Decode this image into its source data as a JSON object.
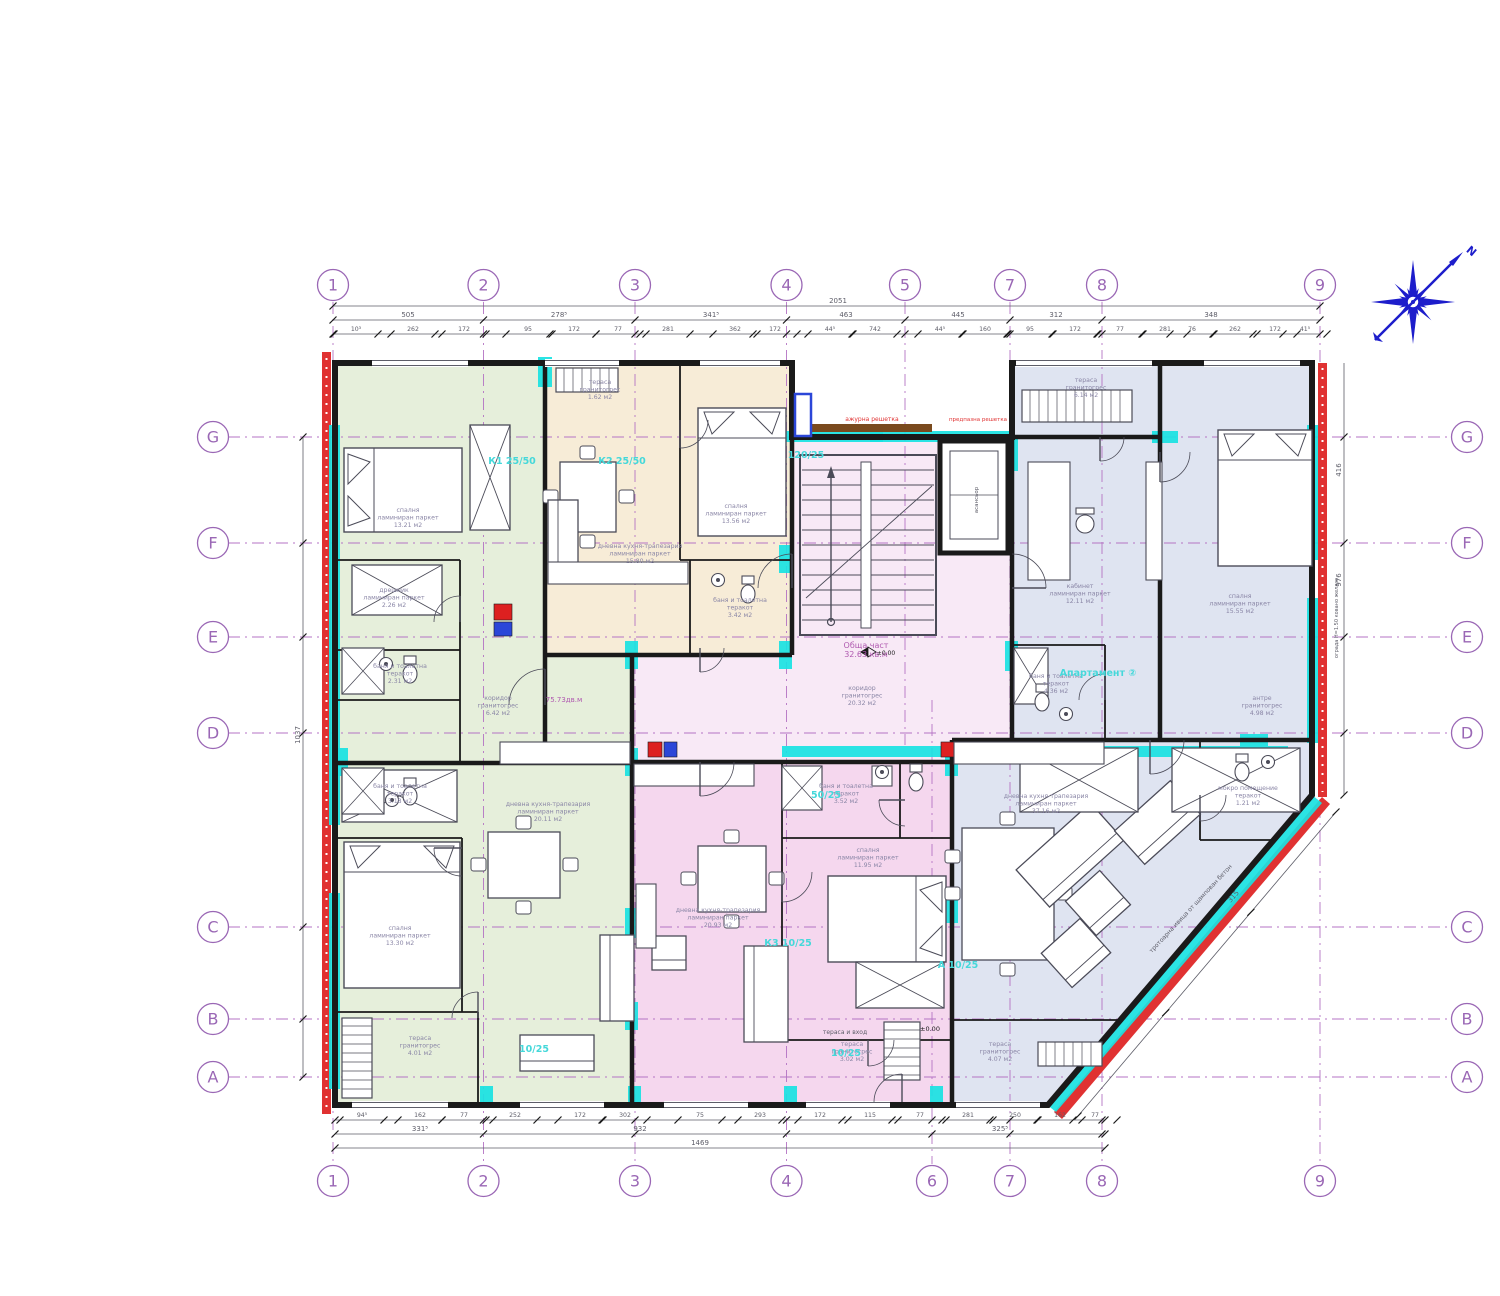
{
  "colors": {
    "green": "#e6efdb",
    "cream": "#f7ecd7",
    "core": "#f8e9f6",
    "pink": "#f5d7ee",
    "blue": "#dfe4f1",
    "cyan": "#19e2e2",
    "red": "#e03232",
    "wall": "#1a1a1a",
    "dim": "#5d5d68",
    "grid": "#b473c4",
    "bubble": "#9a67b5",
    "label": "#8a86a6",
    "code": "#45d8da",
    "purple": "#b05ab0",
    "compass": "#1d1dcb",
    "furn": "#4b4b58",
    "wood": "#7a4a1e",
    "stove": "#dd2020",
    "fridge": "#2b46d8",
    "white": "#ffffff"
  },
  "grid": {
    "top": [
      "1",
      "2",
      "3",
      "4",
      "5",
      "7",
      "8",
      "9"
    ],
    "bottom": [
      "1",
      "2",
      "3",
      "4",
      "6",
      "7",
      "8",
      "9"
    ],
    "left": [
      "G",
      "F",
      "E",
      "D",
      "C",
      "B",
      "A"
    ],
    "right": [
      "G",
      "F",
      "E",
      "D",
      "C",
      "B",
      "A"
    ]
  },
  "compass": {
    "north": "N"
  },
  "dims": {
    "top_total": "2051",
    "top_major": [
      "505",
      "278⁵",
      "341⁵",
      "463",
      "445",
      "312",
      "348"
    ],
    "top_minor": [
      "10³",
      "262",
      "172",
      "95",
      "172",
      "77",
      "281",
      "362",
      "172",
      "44⁵",
      "742",
      "44⁵",
      "160",
      "95",
      "172",
      "77",
      "281",
      "76",
      "262",
      "172",
      "41⁵"
    ],
    "bottom_minor": [
      "94⁵",
      "162",
      "77",
      "252",
      "172",
      "302",
      "75",
      "293",
      "172",
      "115",
      "77",
      "281",
      "250",
      "162",
      "77"
    ],
    "bottom_major": [
      "331⁵",
      "932",
      "325⁵"
    ],
    "bottom_total": "1469",
    "left": [
      "1037"
    ],
    "right": [
      "416",
      "976"
    ],
    "diag": [
      "315"
    ]
  },
  "rooms": [
    {
      "name": "спалня",
      "mat": "ламиниран паркет",
      "area": "13.21 м2"
    },
    {
      "name": "дрешник",
      "mat": "ламиниран паркет",
      "area": "2.26 м2"
    },
    {
      "name": "баня и тоалетна",
      "mat": "теракот",
      "area": "2.31 м2"
    },
    {
      "name": "баня и тоалетна",
      "mat": "теракот",
      "area": "3.18 м2"
    },
    {
      "name": "коридор",
      "mat": "гранитогрес",
      "area": "6.42 м2"
    },
    {
      "name": "дневна кухня-трапезария",
      "mat": "ламиниран паркет",
      "area": "20.11 м2"
    },
    {
      "name": "спалня",
      "mat": "ламиниран паркет",
      "area": "13.30 м2"
    },
    {
      "name": "тераса",
      "mat": "гранитогрес",
      "area": "4.01 м2"
    },
    {
      "name": "тераса",
      "mat": "гранитогрес",
      "area": "1.62 м2"
    },
    {
      "name": "спалня",
      "mat": "ламиниран паркет",
      "area": "13.56 м2"
    },
    {
      "name": "дневна кухня-трапезария",
      "mat": "ламиниран паркет",
      "area": "15.80 м2"
    },
    {
      "name": "баня и тоалетна",
      "mat": "теракот",
      "area": "3.42 м2"
    },
    {
      "name": "Обща част",
      "mat": "",
      "area": "32.63 кв.м"
    },
    {
      "name": "коридор",
      "mat": "гранитогрес",
      "area": "20.32 м2"
    },
    {
      "name": "дневна кухня-трапезария",
      "mat": "ламиниран паркет",
      "area": "20.93 м2"
    },
    {
      "name": "спалня",
      "mat": "ламиниран паркет",
      "area": "11.95 м2"
    },
    {
      "name": "баня и тоалетна",
      "mat": "теракот",
      "area": "3.52 м2"
    },
    {
      "name": "тераса",
      "mat": "гранитогрес",
      "area": "3.02 м2"
    },
    {
      "name": "тераса",
      "mat": "гранитогрес",
      "area": "6.14 м2"
    },
    {
      "name": "кабинет",
      "mat": "ламиниран паркет",
      "area": "12.11 м2"
    },
    {
      "name": "спалня",
      "mat": "ламиниран паркет",
      "area": "15.55 м2"
    },
    {
      "name": "баня и тоалетна",
      "mat": "теракот",
      "area": "4.36 м2"
    },
    {
      "name": "мокро помещение",
      "mat": "теракот",
      "area": "1.21 м2"
    },
    {
      "name": "дневна кухня-трапезария",
      "mat": "ламиниран паркет",
      "area": "37.16 м2"
    },
    {
      "name": "тераса",
      "mat": "гранитогрес",
      "area": "4.07 м2"
    },
    {
      "name": "антре",
      "mat": "гранитогрес",
      "area": "4.98 м2"
    }
  ],
  "codes": [
    "К1 25/50",
    "К2 25/50",
    "120/25",
    "50/25",
    "К3 10/25",
    "А 10/25",
    "10/25",
    "10/25",
    "Апартамент ②"
  ],
  "annotations": [
    "ажурна решетка",
    "предпазна решетка",
    "75.73дв.м",
    "тераса и вход",
    "±0.00",
    "±0.00",
    "топлоизолация ЕПС 8 см",
    "тротоарна ивица от щампован бетон",
    "ограда H=1.50 ковано желязо",
    "асансьор"
  ]
}
